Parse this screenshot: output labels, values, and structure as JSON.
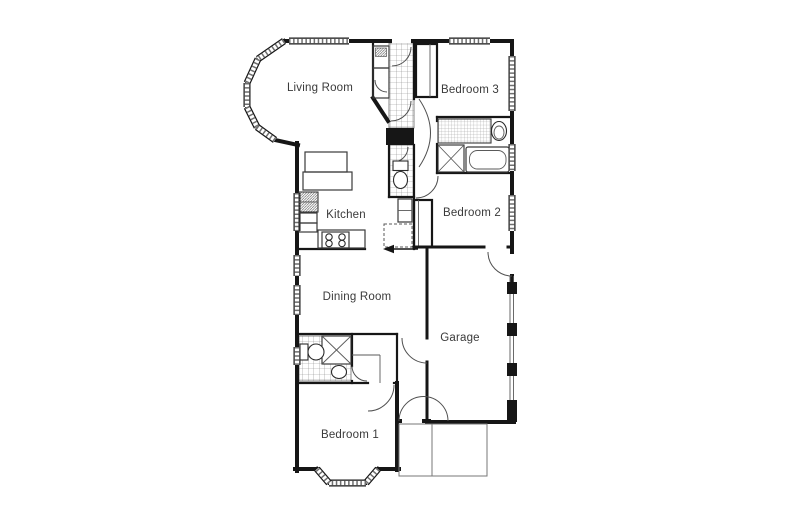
{
  "floor_plan": {
    "rooms": {
      "living_room": "Living Room",
      "bedroom_3": "Bedroom 3",
      "kitchen": "Kitchen",
      "bedroom_2": "Bedroom 2",
      "dining_room": "Dining Room",
      "garage": "Garage",
      "bedroom_1": "Bedroom 1"
    },
    "colors": {
      "wall": "#161616",
      "detail_line": "#3a3a3a",
      "hatch": "#8a8a8a",
      "label_text": "#3a3a3a",
      "background": "#ffffff"
    }
  }
}
